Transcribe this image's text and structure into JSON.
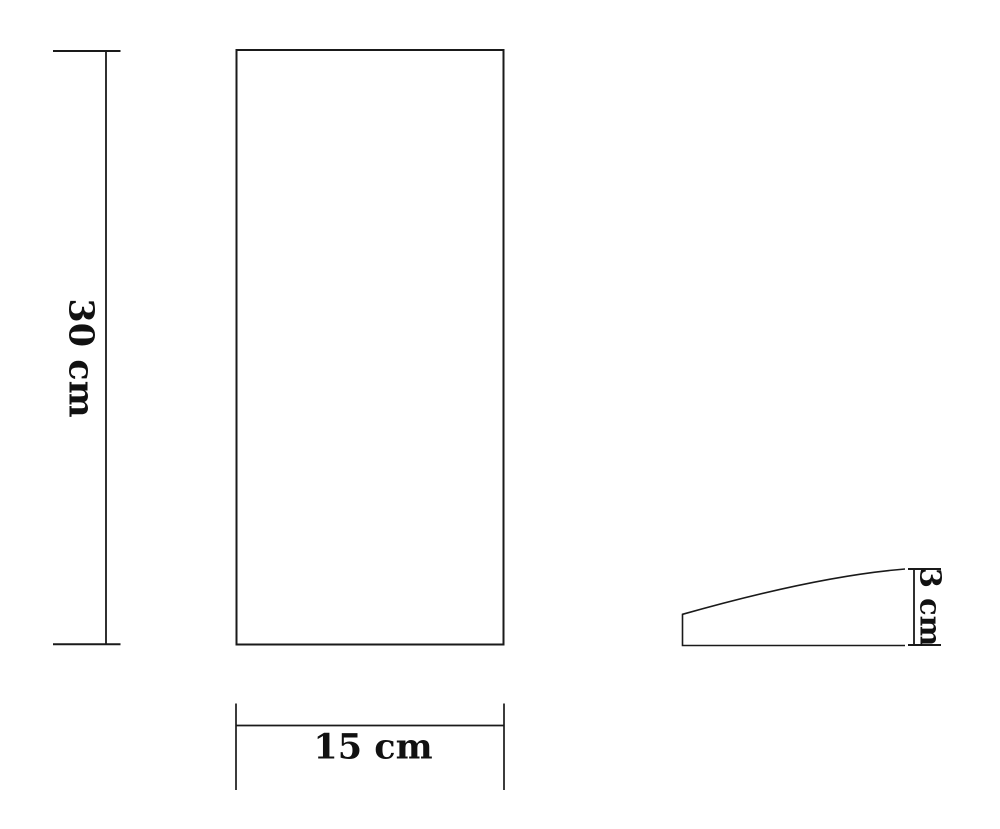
{
  "diagram": {
    "type": "technical-drawing",
    "colors": {
      "line": "#1a1a1a",
      "background": "#ffffff",
      "text": "#111111"
    },
    "front_view": {
      "shape": "rectangle",
      "height_label": "30 cm",
      "width_label": "15 cm"
    },
    "side_view": {
      "shape": "wedge-with-curved-top",
      "thickness_label": "3 cm"
    }
  }
}
